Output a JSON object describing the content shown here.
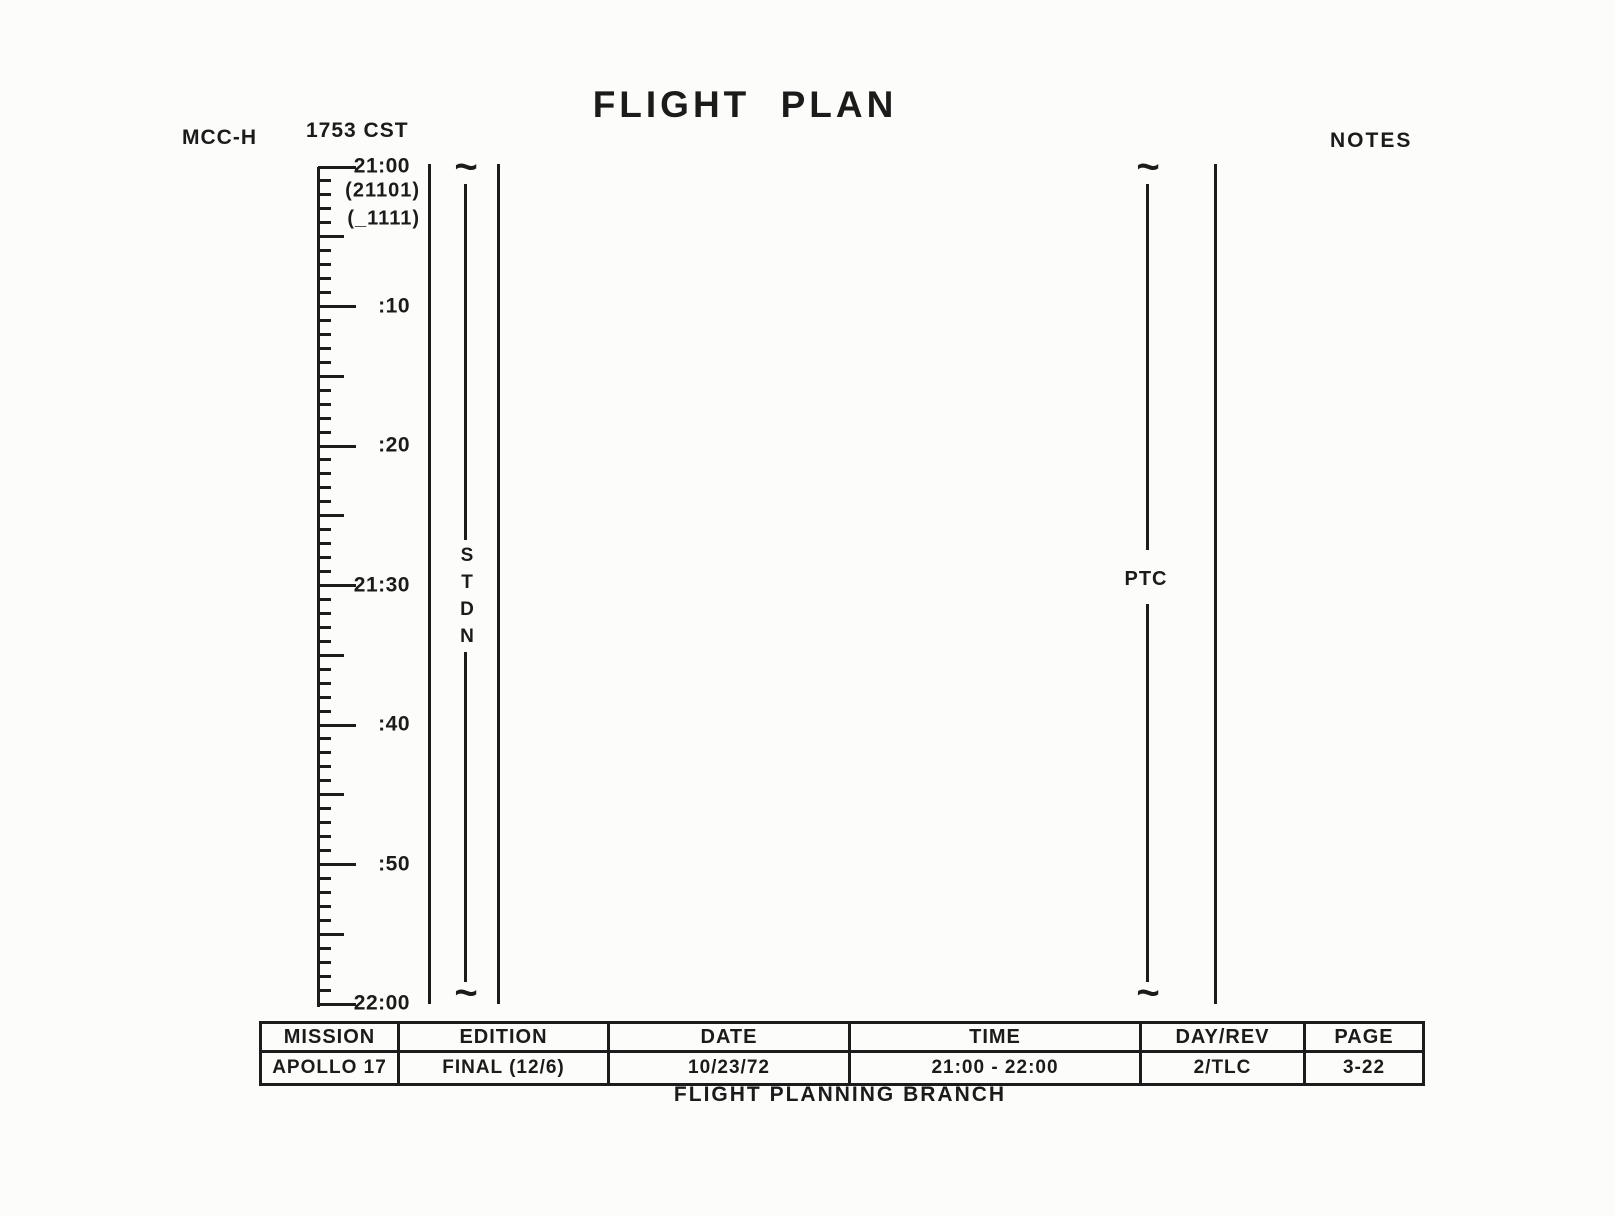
{
  "page": {
    "title": "FLIGHT PLAN",
    "station_label": "MCC-H",
    "cst_time": "1753 CST",
    "notes_label": "NOTES",
    "footer": "FLIGHT PLANNING BRANCH"
  },
  "icons": {
    "continuation_tilde": "~"
  },
  "timescale": {
    "minutes_total": 60,
    "minor_tick_every": 1,
    "medium_tick_every": 5,
    "label_every": 10,
    "tick_labels": [
      {
        "minute": 0,
        "text": "21:00"
      },
      {
        "minute": 10,
        "text": ":10"
      },
      {
        "minute": 20,
        "text": ":20"
      },
      {
        "minute": 30,
        "text": "21:30"
      },
      {
        "minute": 40,
        "text": ":40"
      },
      {
        "minute": 50,
        "text": ":50"
      },
      {
        "minute": 60,
        "text": "22:00"
      }
    ],
    "annotations": [
      "(21101)",
      "(_1111)"
    ]
  },
  "tracks": {
    "stdn": {
      "label": "STDN"
    },
    "ptc": {
      "label": "PTC"
    }
  },
  "footer_table": {
    "headers": [
      "MISSION",
      "EDITION",
      "DATE",
      "TIME",
      "DAY/REV",
      "PAGE"
    ],
    "values": [
      "APOLLO 17",
      "FINAL (12/6)",
      "10/23/72",
      "21:00 - 22:00",
      "2/TLC",
      "3-22"
    ]
  }
}
